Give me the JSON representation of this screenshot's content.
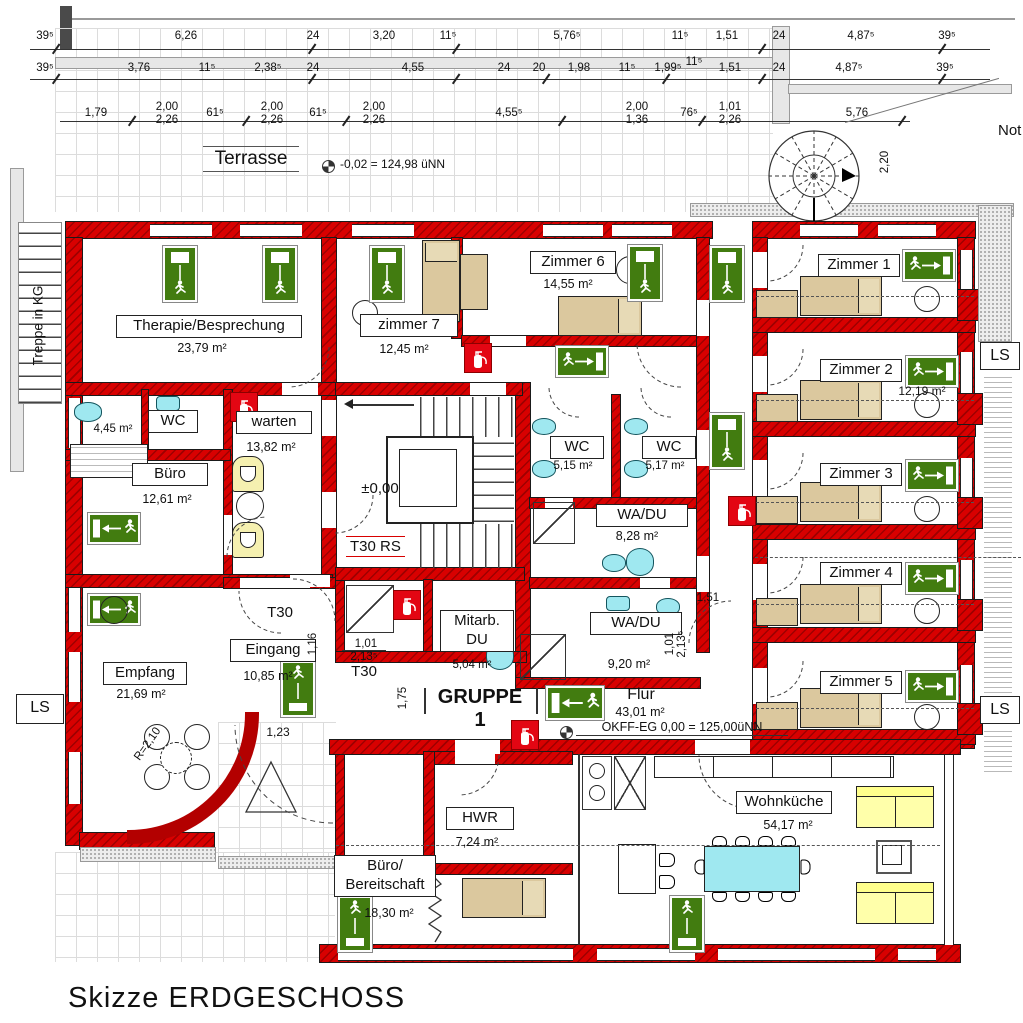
{
  "title": "Skizze ERDGESCHOSS",
  "colors": {
    "wall_red": "#d80000",
    "exit_green": "#427c10",
    "furniture_tan": "#dbc89e",
    "sofa_yellow": "#ffffaa",
    "water_cyan": "#9fe8f0",
    "chair_yellow": "#f5f0b0"
  },
  "top_dims": {
    "row1": [
      "39⁵",
      "6,26",
      "24",
      "3,20",
      "11⁵",
      "5,76⁵",
      "11⁵",
      "1,51",
      "24",
      "4,87⁵",
      "39⁵"
    ],
    "row1_extra": "11⁵",
    "row2": [
      "39⁵",
      "3,76",
      "11⁵",
      "2,38⁵",
      "24",
      "4,55",
      "24",
      "20",
      "1,98",
      "11⁵",
      "1,99⁵",
      "1,51",
      "24",
      "4,87⁵",
      "39⁵"
    ],
    "row3": [
      "1,79",
      "2,00\n2,26",
      "61⁵",
      "2,00\n2,26",
      "61⁵",
      "2,00\n2,26",
      "4,55⁵",
      "2,00\n1,36",
      "76⁵",
      "1,01\n2,26",
      "5,76"
    ]
  },
  "terrace": {
    "label": "Terrasse",
    "level": "-0,02 = 124,98 üNN",
    "stair_width": "2,20",
    "note": "Not"
  },
  "left_stair": {
    "label": "Treppe in KG"
  },
  "rooms": {
    "therapie": {
      "name": "Therapie/Besprechung",
      "area": "23,79 m²"
    },
    "zimmer7": {
      "name": "zimmer 7",
      "area": "12,45 m²"
    },
    "zimmer6": {
      "name": "Zimmer 6",
      "area": "14,55 m²"
    },
    "zimmer1": {
      "name": "Zimmer 1",
      "area": ""
    },
    "zimmer2": {
      "name": "Zimmer 2",
      "area": "12,19 m²"
    },
    "zimmer3": {
      "name": "Zimmer 3",
      "area": ""
    },
    "zimmer4": {
      "name": "Zimmer 4",
      "area": ""
    },
    "zimmer5": {
      "name": "Zimmer 5",
      "area": ""
    },
    "wc_a": {
      "name": "WC",
      "area": "4,45 m²"
    },
    "wc_b": {
      "name": "WC",
      "area": "5,15 m²"
    },
    "wc_c": {
      "name": "WC",
      "area": "5,17 m²"
    },
    "warten": {
      "name": "warten",
      "area": "13,82 m²"
    },
    "buero": {
      "name": "Büro",
      "area": "12,61 m²"
    },
    "empfang": {
      "name": "Empfang",
      "area": "21,69 m²"
    },
    "eingang": {
      "name": "Eingang",
      "area": "10,85 m²"
    },
    "mitarb": {
      "name": "Mitarb.\nDU",
      "area": "5,04 m²"
    },
    "wadu_a": {
      "name": "WA/DU",
      "area": "8,28 m²"
    },
    "wadu_b": {
      "name": "WA/DU",
      "area": "9,20 m²"
    },
    "flur": {
      "name": "Flur",
      "area": "43,01 m²"
    },
    "hwr": {
      "name": "HWR",
      "area": "7,24 m²"
    },
    "bereitschaft": {
      "name": "Büro/\nBereitschaft",
      "area": "18,30 m²"
    },
    "wohnkueche": {
      "name": "Wohnküche",
      "area": "54,17 m²"
    }
  },
  "annotations": {
    "gruppe": "GRUPPE 1",
    "t30rs": "T30 RS",
    "t30_a": "T30",
    "t30_b": "T30",
    "level_zero": "±0,00",
    "okff": "OKFF-EG  0,00 = 125,00üNN",
    "ls": "LS",
    "radius": "R=2,10",
    "d_116": "1,16",
    "d_175": "1,75",
    "d_151": "1,51",
    "d_123": "1,23",
    "d_101a": "1,01",
    "d_213a": "2,13⁵",
    "d_101b": "1,01\n2,13⁵"
  }
}
